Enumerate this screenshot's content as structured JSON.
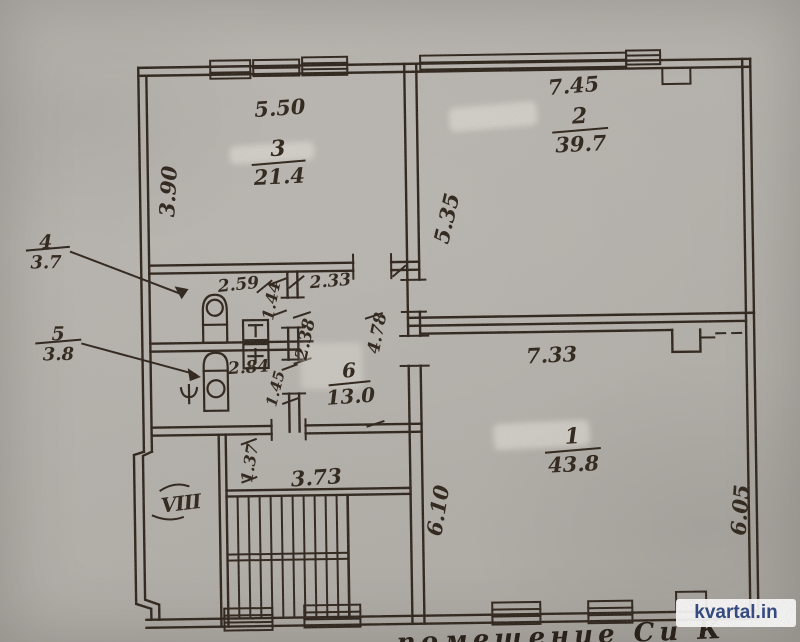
{
  "watermark": {
    "label": "kvartal.in"
  },
  "plan": {
    "stairwell_label": "VIII",
    "bottom_note": "помещение Си К",
    "rooms": [
      {
        "number": "1",
        "area": "43.8"
      },
      {
        "number": "2",
        "area": "39.7"
      },
      {
        "number": "3",
        "area": "21.4"
      },
      {
        "number": "4",
        "area": "3.7"
      },
      {
        "number": "5",
        "area": "3.8"
      },
      {
        "number": "6",
        "area": "13.0"
      }
    ],
    "dimensions": {
      "room3_width": "5.50",
      "room3_depth": "3.90",
      "room2_width": "7.45",
      "room2_depth": "5.35",
      "room1_width": "7.33",
      "room1_depth_left": "6.10",
      "room1_depth_right": "6.05",
      "wc_width": "2.59",
      "wc_depth": "1.44",
      "hall_top": "2.33",
      "hall_left": "2.38",
      "hall_right": "4.78",
      "bath_width": "2.84",
      "bath_depth": "1.45",
      "corridor_length": "3.73",
      "corridor_width": "1.37"
    }
  },
  "ink_color": "#261c13",
  "paper_color": "#b6b2ad"
}
